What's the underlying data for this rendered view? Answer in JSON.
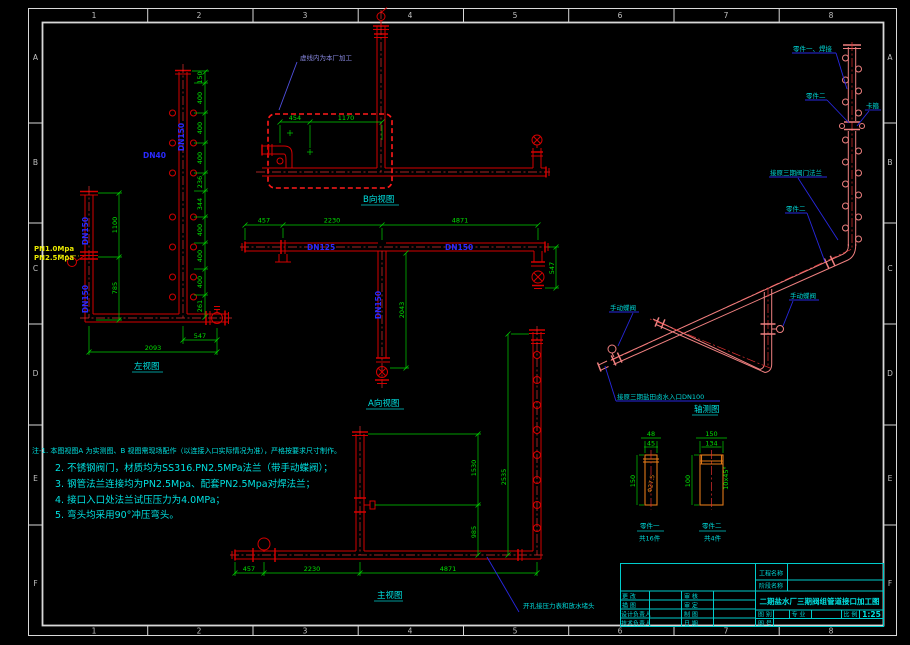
{
  "frame": {
    "zone_letters": [
      "A",
      "B",
      "C",
      "D",
      "E",
      "F"
    ],
    "zone_numbers": [
      "1",
      "2",
      "3",
      "4",
      "5",
      "6",
      "7",
      "8"
    ]
  },
  "colors": {
    "pipe": "#d40000",
    "dimension": "#00d000",
    "annotation": "#00e0e0",
    "dn_label": "#2a2aff",
    "pn_label": "#e8e800",
    "detail_part": "#e07818",
    "iso_pipe": "#ef8080",
    "boundary_box": "#ff1a1a"
  },
  "left_view": {
    "title": "左视图",
    "header_dn": "DN150",
    "branch_dn": "DN40",
    "riser_dn_top": "DN150",
    "riser_dn_bottom": "DN150",
    "pn1": "PN1.0Mpa",
    "pn2": "PN2.5Mpa",
    "chain": [
      "150",
      "400",
      "400",
      "400",
      "236",
      "344",
      "400",
      "400",
      "400",
      "261"
    ],
    "dim_1100": "1100",
    "dim_785": "785",
    "dim_547": "547",
    "dim_2093": "2093"
  },
  "b_view": {
    "title": "B向视图",
    "dim_454": "454",
    "dim_1170": "1170",
    "boundary_note": "虚线内为本厂加工"
  },
  "a_view": {
    "title": "A向视图",
    "dim_457": "457",
    "dim_2230": "2230",
    "dim_4871": "4871",
    "dim_2043": "2043",
    "dim_547": "547",
    "dn125": "DN125",
    "dn150": "DN150",
    "dn150_v": "DN150"
  },
  "front_view": {
    "title": "主视图",
    "dim_457": "457",
    "dim_2230": "2230",
    "dim_4871": "4871",
    "dim_1530": "1530",
    "dim_985": "985",
    "dim_2535": "2535",
    "leader_note": "开孔接压力表和放水堵头"
  },
  "iso_view": {
    "title": "轴测图",
    "leader_part1": "零件一、焊接",
    "leader_part2_top": "零件二",
    "leader_clamp": "卡箍",
    "leader_flange": "接原三期阀门法兰",
    "leader_part2_bottom": "零件二",
    "leader_valve_left": "手动蝶阀",
    "leader_valve_right": "手动蝶阀",
    "leader_inlet": "接原三期盐田卤水入口DN100"
  },
  "part1": {
    "name": "零件一",
    "qty": "共16件",
    "dim_48": "48",
    "dim_45": "45",
    "dim_150": "150",
    "bore": "Φ27.5"
  },
  "part2": {
    "name": "零件二",
    "qty": "共4件",
    "dim_150": "150",
    "dim_134": "134",
    "dim_100": "100",
    "chamfer": "10x45°"
  },
  "notes": {
    "line1": "注-1. 本图视图A 为实测图、B 视图需现场配作（以连接入口实际情况为准），严格按要求尺寸制作。",
    "line2": "2. 不锈钢阀门，材质均为SS316.PN2.5MPa法兰（带手动蝶阀）；",
    "line3": "3. 钢管法兰连接均为PN2.5Mpa、配套PN2.5Mpa对焊法兰；",
    "line4": "4. 接口入口处法兰试压压力为4.0MPa；",
    "line5": "5. 弯头均采用90°冲压弯头。"
  },
  "titleblock": {
    "project_label": "工程名称",
    "stage_label": "阶段名称",
    "rows_col1": [
      "更 改",
      "描 图",
      "设计负责人",
      "技术负责人"
    ],
    "rows_col2": [
      "审 核",
      "审 定",
      "制 图",
      "日 期"
    ],
    "title": "二期盐水厂三期阀组管道接口加工图",
    "type_label": "图 别",
    "discipline_label": "专 业",
    "scale_label": "比 例",
    "scale_value": "1:25",
    "number_label": "图 号"
  }
}
